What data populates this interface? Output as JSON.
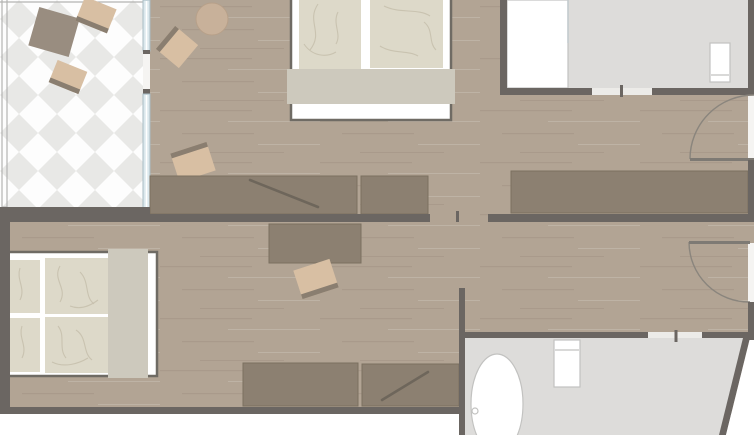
{
  "meta": {
    "type": "architectural-floor-plan",
    "description": "Top-down floor plan of a two-room suite with terrace and two bathrooms",
    "width_px": 754,
    "height_px": 435,
    "visible_text": "none"
  },
  "palette": {
    "background": "#ffffff",
    "wall": "#6b6662",
    "wall_light": "#7e7a74",
    "wood_floor": "#b2a494",
    "wood_streak_dark": "rgba(92,72,55,0.10)",
    "wood_streak_light": "rgba(255,255,255,0.16)",
    "terrace_tile": "#e8e8e6",
    "terrace_tile_bg": "#fdfdfd",
    "railing": "#b4b4b2",
    "bathroom_floor": "#dddcda",
    "fixture_white": "#ffffff",
    "fixture_outline": "#c2c2c0",
    "furniture_dark": "#8c8071",
    "furniture_dark_edge": "#7b7060",
    "furniture_accent_line": "#6e665b",
    "chair_beige": "#d8bfa3",
    "chair_back": "#8a7e70",
    "table_gray": "#998d80",
    "side_table": "#c8b19a",
    "mattress": "#ddd9c9",
    "mattress_crease": "#c6c0ad",
    "bed_frame_outline": "#6f6b64",
    "bed_runner": "#cdc9bd",
    "window_glass": "#dce8ed",
    "window_frame": "#a9bcc4",
    "door_arc": "#8a857d",
    "threshold": "#ecebe8"
  },
  "rooms": [
    {
      "name": "terrace",
      "floor": "diamond-tile",
      "furniture": [
        "outdoor-table",
        "outdoor-chair",
        "outdoor-chair"
      ],
      "boundary": "railing on left and top edges"
    },
    {
      "name": "upper-bedroom",
      "floor": "wood",
      "furniture": [
        "double-bed",
        "foot-runner",
        "armchair",
        "round-side-table",
        "chair",
        "desk-with-diagonal",
        "cabinet",
        "wardrobe"
      ]
    },
    {
      "name": "upper-bathroom",
      "floor": "stone-gray",
      "fixtures": [
        "walk-in-shower",
        "glass-partition",
        "toilet"
      ]
    },
    {
      "name": "lower-bedroom",
      "floor": "wood",
      "furniture": [
        "double-bed",
        "foot-runner",
        "desk",
        "desk-chair",
        "sideboard",
        "sideboard-with-diagonal"
      ]
    },
    {
      "name": "lower-bathroom",
      "floor": "stone-gray",
      "fixtures": [
        "oval-bathtub",
        "drain",
        "toilet"
      ],
      "note": "slanted exterior wall on right"
    }
  ],
  "doors": [
    {
      "name": "upper-entry-door",
      "location": "right wall, upper room",
      "swing": "quarter-arc into room"
    },
    {
      "name": "lower-entry-door",
      "location": "right wall, lower room",
      "swing": "quarter-arc into room"
    },
    {
      "name": "connecting-doorway",
      "location": "wall between rooms, center tick marker"
    },
    {
      "name": "upper-bathroom-doorway",
      "location": "bathroom south wall, center tick marker"
    },
    {
      "name": "lower-bathroom-doorway",
      "location": "bathroom north wall, center tick marker"
    },
    {
      "name": "terrace-door",
      "location": "between terrace and upper bedroom"
    }
  ],
  "windows": [
    {
      "name": "terrace-window-upper",
      "location": "terrace/bedroom divider, top section"
    },
    {
      "name": "terrace-window-lower",
      "location": "terrace/bedroom divider, lower section"
    }
  ]
}
